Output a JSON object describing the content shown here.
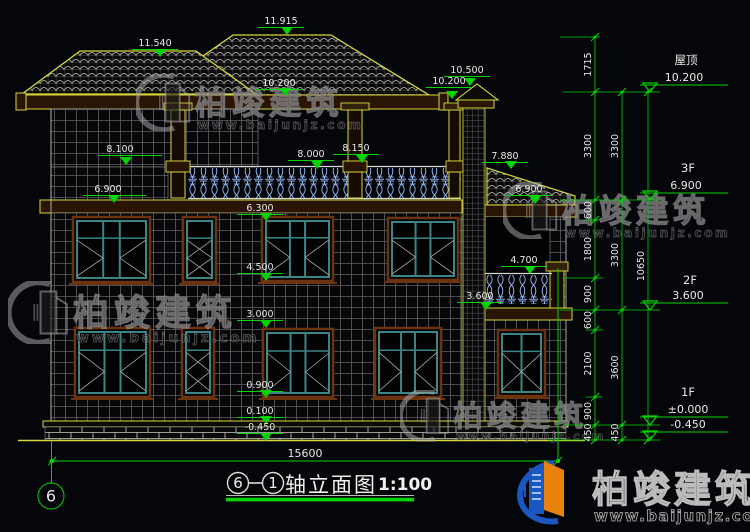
{
  "meta": {
    "background": "#05060a",
    "annotation_green": "#00d400",
    "trim_yellow": "#d6d63e",
    "text_color": "#e8e8e8",
    "baluster_blue": "#8fb0e8",
    "window_teal": "#3a8585",
    "logo_blue": "#1a57c0",
    "logo_orange": "#e8820c"
  },
  "elevation_markers": [
    {
      "label": "11.540",
      "cx": 155,
      "ty": 46,
      "tipx": 160,
      "tipy": 57
    },
    {
      "label": "11.915",
      "cx": 281,
      "ty": 24,
      "tipx": 287,
      "tipy": 35
    },
    {
      "label": "10.200",
      "cx": 279,
      "ty": 86,
      "tipx": 285,
      "tipy": 96
    },
    {
      "label": "10.500",
      "cx": 467,
      "ty": 73,
      "tipx": 470,
      "tipy": 86
    },
    {
      "label": "10.200",
      "cx": 449,
      "ty": 84,
      "tipx": 452,
      "tipy": 99
    },
    {
      "label": "8.100",
      "cx": 120,
      "ty": 152,
      "tipx": 126,
      "tipy": 165,
      "ux1": 98,
      "ux2": 162
    },
    {
      "label": "8.000",
      "cx": 311,
      "ty": 157,
      "tipx": 317,
      "tipy": 169
    },
    {
      "label": "8.150",
      "cx": 356,
      "ty": 151,
      "tipx": 362,
      "tipy": 163
    },
    {
      "label": "7.880",
      "cx": 505,
      "ty": 159,
      "tipx": 511,
      "tipy": 169
    },
    {
      "label": "6.900",
      "cx": 108,
      "ty": 192,
      "tipx": 114,
      "tipy": 203,
      "ux1": 83,
      "ux2": 146
    },
    {
      "label": "6.900",
      "cx": 529,
      "ty": 192,
      "tipx": 535,
      "tipy": 204
    },
    {
      "label": "6.300",
      "cx": 260,
      "ty": 211,
      "tipx": 266,
      "tipy": 221
    },
    {
      "label": "4.500",
      "cx": 260,
      "ty": 270,
      "tipx": 266,
      "tipy": 281
    },
    {
      "label": "4.700",
      "cx": 524,
      "ty": 263,
      "tipx": 530,
      "tipy": 274
    },
    {
      "label": "3.600",
      "cx": 480,
      "ty": 299,
      "tipx": 486,
      "tipy": 310
    },
    {
      "label": "3.000",
      "cx": 260,
      "ty": 317,
      "tipx": 266,
      "tipy": 328
    },
    {
      "label": "0.900",
      "cx": 260,
      "ty": 388,
      "tipx": 266,
      "tipy": 398
    },
    {
      "label": "0.100",
      "cx": 260,
      "ty": 414,
      "tipx": 266,
      "tipy": 424
    },
    {
      "label": "-0.450",
      "cx": 260,
      "ty": 430,
      "tipx": 266,
      "tipy": 441
    }
  ],
  "right_levels": [
    {
      "floor": "屋顶",
      "value": "10.200",
      "fx": 686,
      "fy": 64,
      "vx": 684,
      "vy": 81,
      "level": 92
    },
    {
      "floor": "3F",
      "value": "6.900",
      "fx": 688,
      "fy": 172,
      "vx": 686,
      "vy": 189,
      "level": 200
    },
    {
      "floor": "2F",
      "value": "3.600",
      "fx": 690,
      "fy": 284,
      "vx": 688,
      "vy": 299,
      "level": 310
    },
    {
      "floor": "1F",
      "value": "±0.000",
      "fx": 688,
      "fy": 396,
      "vx": 688,
      "vy": 413,
      "level": 425
    },
    {
      "floor": "",
      "value": "-0.450",
      "fx": 688,
      "fy": 0,
      "vx": 688,
      "vy": 428,
      "level": 440
    }
  ],
  "dim_chains": [
    {
      "x": 595,
      "segments": [
        {
          "label": "1715",
          "y1": 37,
          "y2": 92
        },
        {
          "label": "3300",
          "y1": 92,
          "y2": 200
        },
        {
          "label": "600",
          "y1": 200,
          "y2": 220
        },
        {
          "label": "1800",
          "y1": 220,
          "y2": 278
        },
        {
          "label": "900",
          "y1": 278,
          "y2": 310
        },
        {
          "label": "600",
          "y1": 310,
          "y2": 330
        },
        {
          "label": "2100",
          "y1": 330,
          "y2": 397
        },
        {
          "label": "900",
          "y1": 397,
          "y2": 425
        },
        {
          "label": "450",
          "y1": 425,
          "y2": 440
        }
      ]
    },
    {
      "x": 622,
      "segments": [
        {
          "label": "3300",
          "y1": 92,
          "y2": 200
        },
        {
          "label": "3300",
          "y1": 200,
          "y2": 310
        },
        {
          "label": "3600",
          "y1": 310,
          "y2": 425
        },
        {
          "label": "450",
          "y1": 425,
          "y2": 440
        }
      ]
    },
    {
      "x": 648,
      "segments": [
        {
          "label": "10650",
          "y1": 92,
          "y2": 440
        }
      ]
    }
  ],
  "connector_lines": [
    {
      "y": 37,
      "x1": 560,
      "x2": 600
    },
    {
      "y": 92,
      "x1": 563,
      "x2": 660
    },
    {
      "y": 200,
      "x1": 560,
      "x2": 660
    },
    {
      "y": 220,
      "x1": 584,
      "x2": 600
    },
    {
      "y": 278,
      "x1": 563,
      "x2": 603
    },
    {
      "y": 310,
      "x1": 560,
      "x2": 660
    },
    {
      "y": 330,
      "x1": 586,
      "x2": 603
    },
    {
      "y": 397,
      "x1": 586,
      "x2": 603
    },
    {
      "y": 425,
      "x1": 563,
      "x2": 660
    },
    {
      "y": 440,
      "x1": 548,
      "x2": 660
    }
  ],
  "bottom_dim": {
    "label": "15600",
    "x1": 52,
    "x2": 558,
    "y": 461,
    "lx": 305,
    "ly": 457
  },
  "axis_bubble": {
    "label": "6",
    "cx": 51,
    "cy": 496,
    "r": 13
  },
  "title": {
    "axis_from": "6",
    "axis_to": "1",
    "name": "轴立面图",
    "scale": "1:100"
  },
  "watermarks": [
    {
      "x": 136,
      "y": 74,
      "s": 0.95,
      "text": "柏竣建筑",
      "url": "www.baijunjz.com"
    },
    {
      "x": 503,
      "y": 182,
      "s": 0.95,
      "text": "柏竣建筑",
      "url": "www.baijunjz.com"
    },
    {
      "x": 8,
      "y": 281,
      "s": 1.05,
      "text": "柏竣建筑",
      "url": "www.baijunjz.com"
    },
    {
      "x": 400,
      "y": 390,
      "s": 0.86,
      "text": "柏竣建筑",
      "url": "www.baijunjz.com"
    }
  ],
  "logo": {
    "text": "柏竣建筑",
    "url": "www.baijunjz.com"
  },
  "drawing": {
    "windows": [
      {
        "x": 73,
        "y": 217,
        "w": 77,
        "h": 65,
        "lights": 3
      },
      {
        "x": 183,
        "y": 217,
        "w": 33,
        "h": 65,
        "lights": 1
      },
      {
        "x": 262,
        "y": 217,
        "w": 71,
        "h": 64,
        "lights": 3
      },
      {
        "x": 388,
        "y": 218,
        "w": 70,
        "h": 62,
        "lights": 3
      },
      {
        "x": 75,
        "y": 328,
        "w": 75,
        "h": 69,
        "lights": 3
      },
      {
        "x": 182,
        "y": 328,
        "w": 32,
        "h": 69,
        "lights": 1
      },
      {
        "x": 263,
        "y": 329,
        "w": 70,
        "h": 68,
        "lights": 3
      },
      {
        "x": 375,
        "y": 328,
        "w": 66,
        "h": 69,
        "lights": 3
      },
      {
        "x": 498,
        "y": 330,
        "w": 47,
        "h": 66,
        "lights": 2
      }
    ]
  }
}
